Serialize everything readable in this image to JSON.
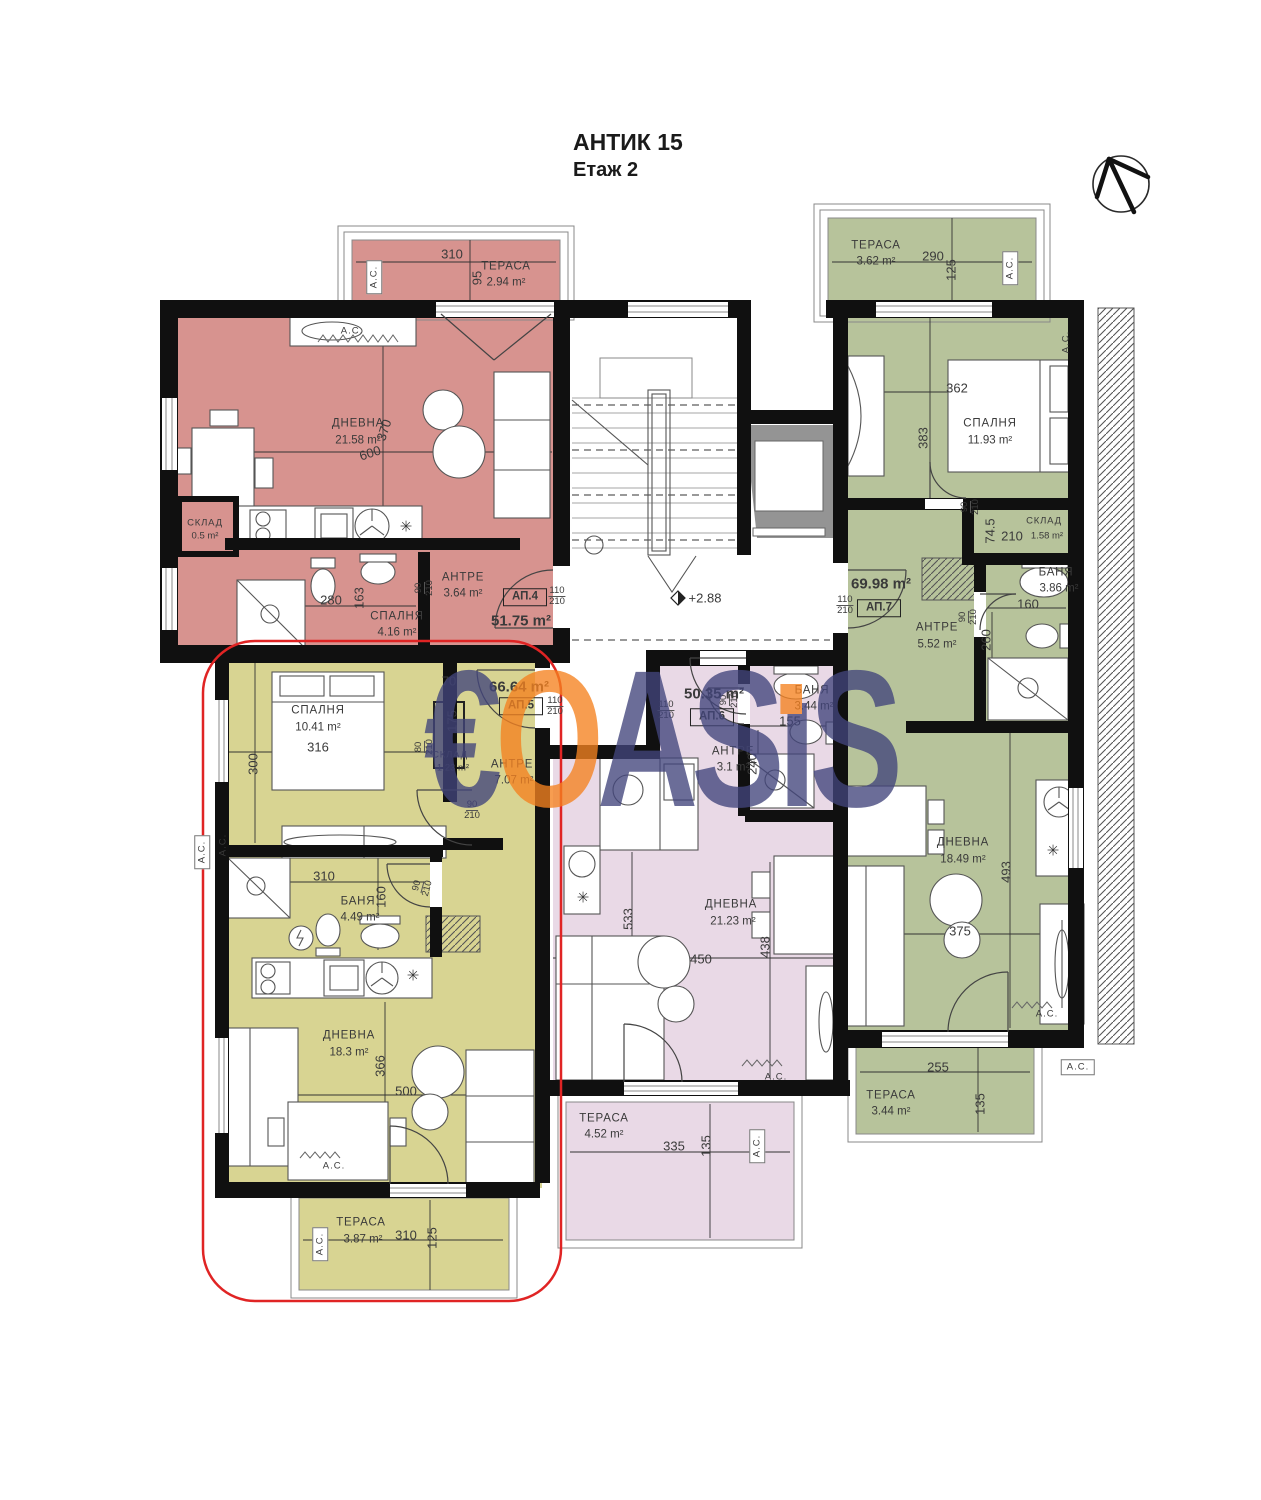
{
  "header": {
    "title": "АНТИК 15",
    "subtitle": "Етаж 2"
  },
  "level_mark": "+2.88",
  "colors": {
    "rose": "#d7938f",
    "olive": "#d8d492",
    "sage": "#b7c39b",
    "pink": "#e9d9e6",
    "outline_red": "#e02424",
    "watermark_blue": "#42457c",
    "watermark_orange": "#f58220",
    "wall_black": "#101010"
  },
  "watermark": {
    "letters": [
      {
        "ch": "€",
        "c": "#42457c"
      },
      {
        "ch": "O",
        "c": "#f58220"
      },
      {
        "ch": "A",
        "c": "#42457c"
      },
      {
        "ch": "S",
        "c": "#42457c"
      },
      {
        "ch": "ı",
        "c": "#42457c",
        "dot": "#f58220"
      },
      {
        "ch": "S",
        "c": "#42457c"
      }
    ]
  },
  "apartments": [
    {
      "id": "АП.4",
      "color_key": "rose",
      "total_area": "51.75 m²",
      "entry_door": "110/210",
      "rooms": [
        {
          "name": "ТЕРАСА",
          "area": "2.94 m²"
        },
        {
          "name": "ДНЕВНА",
          "area": "21.58 m²"
        },
        {
          "name": "СКЛАД",
          "area": "0.5 m²"
        },
        {
          "name": "СПАЛНЯ",
          "area": "4.16 m²"
        },
        {
          "name": "АНТРЕ",
          "area": "3.64 m²"
        }
      ]
    },
    {
      "id": "АП.5",
      "color_key": "olive",
      "total_area": "66.64 m²",
      "entry_door": "110/210",
      "highlighted": true,
      "rooms": [
        {
          "name": "СПАЛНЯ",
          "area": "10.41 m²"
        },
        {
          "name": "СКЛАД",
          "area": "1.23 m²"
        },
        {
          "name": "АНТРЕ",
          "area": "7.07 m²"
        },
        {
          "name": "БАНЯ",
          "area": "4.49 m²"
        },
        {
          "name": "ДНЕВНА",
          "area": "18.3 m²"
        },
        {
          "name": "ТЕРАСА",
          "area": "3.87 m²"
        }
      ]
    },
    {
      "id": "АП.6",
      "color_key": "pink",
      "total_area": "50.35 m²",
      "entry_door": "110/210",
      "rooms": [
        {
          "name": "АНТРЕ",
          "area": "3.1 m²"
        },
        {
          "name": "БАНЯ",
          "area": "3.44 m²"
        },
        {
          "name": "ДНЕВНА",
          "area": "21.23 m²"
        },
        {
          "name": "ТЕРАСА",
          "area": "4.52 m²"
        }
      ]
    },
    {
      "id": "АП.7",
      "color_key": "sage",
      "total_area": "69.98 m²",
      "entry_door": "110/210",
      "rooms": [
        {
          "name": "ТЕРАСА",
          "area": "3.62 m²"
        },
        {
          "name": "СПАЛНЯ",
          "area": "11.93 m²"
        },
        {
          "name": "СКЛАД",
          "area": "1.58 m²"
        },
        {
          "name": "БАНЯ",
          "area": "3.86 m²"
        },
        {
          "name": "АНТРЕ",
          "area": "5.52 m²"
        },
        {
          "name": "ДНЕВНА",
          "area": "18.49 m²"
        },
        {
          "name": "ТЕРАСА",
          "area": "3.44 m²"
        }
      ]
    }
  ],
  "plan": {
    "labels": [
      {
        "n": "ap4-terrace-name",
        "t": "ТЕРАСА",
        "x": 506,
        "y": 267,
        "c": "rm"
      },
      {
        "n": "ap4-terrace-area",
        "t": "2.94 m²",
        "x": 506,
        "y": 283,
        "c": "ar"
      },
      {
        "n": "ap4-terrace-ac",
        "t": "А.С.",
        "x": 374,
        "y": 277,
        "c": "acbox",
        "r": -90
      },
      {
        "n": "ap4-terrace-dim-w",
        "t": "310",
        "x": 452,
        "y": 254,
        "c": "dim"
      },
      {
        "n": "ap4-terrace-dim-h",
        "t": "95",
        "x": 477,
        "y": 278,
        "c": "dim",
        "r": -90
      },
      {
        "n": "ap4-ac",
        "t": "А.С.",
        "x": 352,
        "y": 331,
        "c": "ac"
      },
      {
        "n": "ap4-living-name",
        "t": "ДНЕВНА",
        "x": 358,
        "y": 424,
        "c": "rm"
      },
      {
        "n": "ap4-living-area",
        "t": "21.58 m²",
        "x": 358,
        "y": 441,
        "c": "ar"
      },
      {
        "n": "ap4-dim-600",
        "t": "600",
        "x": 370,
        "y": 453,
        "c": "dim",
        "r": -18
      },
      {
        "n": "ap4-dim-370",
        "t": "370",
        "x": 384,
        "y": 430,
        "c": "dim",
        "r": -72
      },
      {
        "n": "ap4-storage-name",
        "t": "СКЛАД",
        "x": 205,
        "y": 523,
        "c": "rm sm"
      },
      {
        "n": "ap4-storage-area",
        "t": "0.5 m²",
        "x": 205,
        "y": 536,
        "c": "ar sm"
      },
      {
        "n": "ap4-dim-280",
        "t": "280",
        "x": 331,
        "y": 600,
        "c": "dim"
      },
      {
        "n": "ap4-dim-163",
        "t": "163",
        "x": 359,
        "y": 598,
        "c": "dim",
        "r": -90
      },
      {
        "n": "ap4-bedroom-name",
        "t": "СПАЛНЯ",
        "x": 397,
        "y": 617,
        "c": "rm"
      },
      {
        "n": "ap4-bedroom-area",
        "t": "4.16 m²",
        "x": 397,
        "y": 633,
        "c": "ar"
      },
      {
        "n": "ap4-hall-name",
        "t": "АНТРЕ",
        "x": 463,
        "y": 578,
        "c": "rm"
      },
      {
        "n": "ap4-hall-area",
        "t": "3.64 m²",
        "x": 463,
        "y": 594,
        "c": "ar"
      },
      {
        "n": "ap4-door-90-210",
        "t": "90",
        "t2": "210",
        "x": 424,
        "y": 588,
        "c": "frac",
        "r": -90
      },
      {
        "n": "ap4-unit-label",
        "t": "АП.4",
        "x": 525,
        "y": 597,
        "c": "ap"
      },
      {
        "n": "ap4-door-110-210",
        "t": "110",
        "t2": "210",
        "x": 557,
        "y": 596,
        "c": "frac"
      },
      {
        "n": "ap4-total-area",
        "t": "51.75 m²",
        "x": 521,
        "y": 621,
        "c": "big"
      },
      {
        "n": "level-mark",
        "t": "+2.88",
        "x": 705,
        "y": 598,
        "c": "dim"
      },
      {
        "n": "ap7-terrace-top-name",
        "t": "ТЕРАСА",
        "x": 876,
        "y": 246,
        "c": "rm"
      },
      {
        "n": "ap7-terrace-top-area",
        "t": "3.62 m²",
        "x": 876,
        "y": 262,
        "c": "ar"
      },
      {
        "n": "ap7-terrace-top-dim-w",
        "t": "290",
        "x": 933,
        "y": 256,
        "c": "dim"
      },
      {
        "n": "ap7-terrace-top-dim-h",
        "t": "125",
        "x": 951,
        "y": 270,
        "c": "dim",
        "r": -90
      },
      {
        "n": "ap7-terrace-top-ac",
        "t": "А.С.",
        "x": 1010,
        "y": 268,
        "c": "acbox",
        "r": -90
      },
      {
        "n": "ap7-wardrobe-ac",
        "t": "А.С.",
        "x": 1066,
        "y": 342,
        "c": "ac sm",
        "r": -90
      },
      {
        "n": "ap7-bedroom-dim-362",
        "t": "362",
        "x": 957,
        "y": 388,
        "c": "dim"
      },
      {
        "n": "ap7-bedroom-dim-383",
        "t": "383",
        "x": 923,
        "y": 438,
        "c": "dim",
        "r": -90
      },
      {
        "n": "ap7-bedroom-name",
        "t": "СПАЛНЯ",
        "x": 990,
        "y": 424,
        "c": "rm"
      },
      {
        "n": "ap7-bedroom-area",
        "t": "11.93 m²",
        "x": 990,
        "y": 441,
        "c": "ar"
      },
      {
        "n": "ap7-storage-door",
        "t": "90",
        "t2": "210",
        "x": 970,
        "y": 507,
        "c": "frac",
        "r": -90
      },
      {
        "n": "ap7-storage-dim-745",
        "t": "74.5",
        "x": 990,
        "y": 531,
        "c": "dim",
        "r": -90
      },
      {
        "n": "ap7-storage-dim-210",
        "t": "210",
        "x": 1012,
        "y": 536,
        "c": "dim"
      },
      {
        "n": "ap7-storage-name",
        "t": "СКЛАД",
        "x": 1044,
        "y": 521,
        "c": "rm sm"
      },
      {
        "n": "ap7-storage-area",
        "t": "1.58 m²",
        "x": 1047,
        "y": 536,
        "c": "ar sm"
      },
      {
        "n": "ap7-bath-name",
        "t": "БАНЯ",
        "x": 1056,
        "y": 573,
        "c": "rm"
      },
      {
        "n": "ap7-bath-area",
        "t": "3.86 m²",
        "x": 1059,
        "y": 589,
        "c": "ar"
      },
      {
        "n": "ap7-bath-dim-160",
        "t": "160",
        "x": 1028,
        "y": 604,
        "c": "dim"
      },
      {
        "n": "ap7-bath-dim-260",
        "t": "260",
        "x": 986,
        "y": 640,
        "c": "dim",
        "r": -90
      },
      {
        "n": "ap7-bath-door",
        "t": "90",
        "t2": "210",
        "x": 968,
        "y": 617,
        "c": "frac",
        "r": -90
      },
      {
        "n": "ap7-total-area",
        "t": "69.98 m²",
        "x": 881,
        "y": 584,
        "c": "big"
      },
      {
        "n": "ap7-unit-label",
        "t": "АП.7",
        "x": 879,
        "y": 608,
        "c": "ap"
      },
      {
        "n": "ap7-door-110-210",
        "t": "110",
        "t2": "210",
        "x": 845,
        "y": 605,
        "c": "frac"
      },
      {
        "n": "ap7-hall-name",
        "t": "АНТРЕ",
        "x": 937,
        "y": 628,
        "c": "rm"
      },
      {
        "n": "ap7-hall-area",
        "t": "5.52 m²",
        "x": 937,
        "y": 645,
        "c": "ar"
      },
      {
        "n": "ap7-living-name",
        "t": "ДНЕВНА",
        "x": 963,
        "y": 843,
        "c": "rm"
      },
      {
        "n": "ap7-living-area",
        "t": "18.49 m²",
        "x": 963,
        "y": 860,
        "c": "ar"
      },
      {
        "n": "ap7-living-dim-493",
        "t": "493",
        "x": 1006,
        "y": 872,
        "c": "dim",
        "r": -90
      },
      {
        "n": "ap7-living-dim-375",
        "t": "375",
        "x": 960,
        "y": 931,
        "c": "dim"
      },
      {
        "n": "ap7-living-ac",
        "t": "А.С.",
        "x": 1047,
        "y": 1014,
        "c": "ac"
      },
      {
        "n": "ap7-terrace-bottom-dim-255",
        "t": "255",
        "x": 938,
        "y": 1067,
        "c": "dim"
      },
      {
        "n": "ap7-terrace-bottom-dim-135",
        "t": "135",
        "x": 980,
        "y": 1104,
        "c": "dim",
        "r": -90
      },
      {
        "n": "ap7-terrace-bottom-name",
        "t": "ТЕРАСА",
        "x": 891,
        "y": 1096,
        "c": "rm"
      },
      {
        "n": "ap7-terrace-bottom-area",
        "t": "3.44 m²",
        "x": 891,
        "y": 1112,
        "c": "ar"
      },
      {
        "n": "ap7-terrace-bottom-ac",
        "t": "А.С.",
        "x": 1078,
        "y": 1067,
        "c": "acbox"
      },
      {
        "n": "ap6-total-area",
        "t": "50.35 m²",
        "x": 714,
        "y": 694,
        "c": "big"
      },
      {
        "n": "ap6-unit-label",
        "t": "АП.6",
        "x": 712,
        "y": 717,
        "c": "ap"
      },
      {
        "n": "ap6-door-110-210",
        "t": "110",
        "t2": "210",
        "x": 666,
        "y": 710,
        "c": "frac"
      },
      {
        "n": "ap6-bath-door",
        "t": "90",
        "t2": "210",
        "x": 729,
        "y": 700,
        "c": "frac",
        "r": -90
      },
      {
        "n": "ap6-bath-name",
        "t": "БАНЯ",
        "x": 812,
        "y": 691,
        "c": "rm"
      },
      {
        "n": "ap6-bath-area",
        "t": "3.44 m²",
        "x": 814,
        "y": 707,
        "c": "ar"
      },
      {
        "n": "ap6-bath-dim-155",
        "t": "155",
        "x": 790,
        "y": 721,
        "c": "dim"
      },
      {
        "n": "ap6-bath-dim-240",
        "t": "240",
        "x": 752,
        "y": 764,
        "c": "dim",
        "r": -90
      },
      {
        "n": "ap6-hall-name",
        "t": "АНТРЕ",
        "x": 733,
        "y": 752,
        "c": "rm"
      },
      {
        "n": "ap6-hall-area",
        "t": "3.1 m²",
        "x": 733,
        "y": 768,
        "c": "ar"
      },
      {
        "n": "ap6-living-name",
        "t": "ДНЕВНА",
        "x": 731,
        "y": 905,
        "c": "rm"
      },
      {
        "n": "ap6-living-area",
        "t": "21.23 m²",
        "x": 733,
        "y": 922,
        "c": "ar"
      },
      {
        "n": "ap6-living-dim-533",
        "t": "533",
        "x": 628,
        "y": 919,
        "c": "dim",
        "r": -90
      },
      {
        "n": "ap6-living-dim-450",
        "t": "450",
        "x": 701,
        "y": 959,
        "c": "dim"
      },
      {
        "n": "ap6-living-dim-438",
        "t": "438",
        "x": 765,
        "y": 947,
        "c": "dim",
        "r": -90
      },
      {
        "n": "ap6-living-ac",
        "t": "А.С.",
        "x": 776,
        "y": 1077,
        "c": "ac"
      },
      {
        "n": "ap6-terrace-name",
        "t": "ТЕРАСА",
        "x": 604,
        "y": 1119,
        "c": "rm"
      },
      {
        "n": "ap6-terrace-area",
        "t": "4.52 m²",
        "x": 604,
        "y": 1135,
        "c": "ar"
      },
      {
        "n": "ap6-terrace-dim-335",
        "t": "335",
        "x": 674,
        "y": 1146,
        "c": "dim"
      },
      {
        "n": "ap6-terrace-dim-135",
        "t": "135",
        "x": 706,
        "y": 1146,
        "c": "dim",
        "r": -90
      },
      {
        "n": "ap6-terrace-ac",
        "t": "А.С.",
        "x": 757,
        "y": 1146,
        "c": "acbox",
        "r": -90
      },
      {
        "n": "ap5-bedroom-name",
        "t": "СПАЛНЯ",
        "x": 318,
        "y": 711,
        "c": "rm"
      },
      {
        "n": "ap5-bedroom-area",
        "t": "10.41 m²",
        "x": 318,
        "y": 728,
        "c": "ar"
      },
      {
        "n": "ap5-bedroom-dim-316",
        "t": "316",
        "x": 318,
        "y": 747,
        "c": "dim"
      },
      {
        "n": "ap5-bedroom-dim-300",
        "t": "300",
        "x": 253,
        "y": 764,
        "c": "dim",
        "r": -90
      },
      {
        "n": "ap5-storage-dim-70",
        "t": "70",
        "x": 449,
        "y": 681,
        "c": "dim"
      },
      {
        "n": "ap5-storage-dim-175",
        "t": "175",
        "x": 452,
        "y": 721,
        "c": "dim",
        "r": -90
      },
      {
        "n": "ap5-storage-door",
        "t": "80",
        "t2": "210",
        "x": 424,
        "y": 747,
        "c": "frac",
        "r": -90
      },
      {
        "n": "ap5-storage-name",
        "t": "СКЛАД",
        "x": 450,
        "y": 755,
        "c": "rm sm"
      },
      {
        "n": "ap5-storage-area",
        "t": "1.23 m²",
        "x": 453,
        "y": 768,
        "c": "ar sm"
      },
      {
        "n": "ap5-total-area",
        "t": "66.64 m²",
        "x": 519,
        "y": 687,
        "c": "big"
      },
      {
        "n": "ap5-unit-label",
        "t": "АП.5",
        "x": 521,
        "y": 706,
        "c": "ap"
      },
      {
        "n": "ap5-door-110-210",
        "t": "110",
        "t2": "210",
        "x": 555,
        "y": 706,
        "c": "frac"
      },
      {
        "n": "ap5-hall-name",
        "t": "АНТРЕ",
        "x": 512,
        "y": 765,
        "c": "rm"
      },
      {
        "n": "ap5-hall-area",
        "t": "7.07 m²",
        "x": 514,
        "y": 781,
        "c": "ar"
      },
      {
        "n": "ap5-bedroom-door",
        "t": "90",
        "t2": "210",
        "x": 472,
        "y": 810,
        "c": "frac"
      },
      {
        "n": "ap5-ac-outer",
        "t": "А.С.",
        "x": 202,
        "y": 852,
        "c": "acbox",
        "r": -90
      },
      {
        "n": "ap5-ac-inner",
        "t": "А.С.",
        "x": 223,
        "y": 845,
        "c": "ac sm",
        "r": -90
      },
      {
        "n": "ap5-bath-dim-310",
        "t": "310",
        "x": 324,
        "y": 876,
        "c": "dim"
      },
      {
        "n": "ap5-bath-name",
        "t": "БАНЯ",
        "x": 358,
        "y": 902,
        "c": "rm"
      },
      {
        "n": "ap5-bath-area",
        "t": "4.49 m²",
        "x": 360,
        "y": 918,
        "c": "ar"
      },
      {
        "n": "ap5-bath-dim-160",
        "t": "160",
        "x": 381,
        "y": 897,
        "c": "dim",
        "r": -90
      },
      {
        "n": "ap5-bath-door",
        "t": "90",
        "t2": "210",
        "x": 422,
        "y": 887,
        "c": "frac",
        "r": -75
      },
      {
        "n": "ap5-living-name",
        "t": "ДНЕВНА",
        "x": 349,
        "y": 1036,
        "c": "rm"
      },
      {
        "n": "ap5-living-area",
        "t": "18.3 m²",
        "x": 349,
        "y": 1053,
        "c": "ar"
      },
      {
        "n": "ap5-living-dim-366",
        "t": "366",
        "x": 380,
        "y": 1066,
        "c": "dim",
        "r": -90
      },
      {
        "n": "ap5-living-dim-500",
        "t": "500",
        "x": 406,
        "y": 1091,
        "c": "dim"
      },
      {
        "n": "ap5-living-ac",
        "t": "А.С.",
        "x": 334,
        "y": 1166,
        "c": "ac"
      },
      {
        "n": "ap5-terrace-name",
        "t": "ТЕРАСА",
        "x": 361,
        "y": 1223,
        "c": "rm"
      },
      {
        "n": "ap5-terrace-area",
        "t": "3.87 m²",
        "x": 363,
        "y": 1240,
        "c": "ar"
      },
      {
        "n": "ap5-terrace-dim-310",
        "t": "310",
        "x": 406,
        "y": 1235,
        "c": "dim"
      },
      {
        "n": "ap5-terrace-dim-125",
        "t": "125",
        "x": 432,
        "y": 1238,
        "c": "dim",
        "r": -90
      },
      {
        "n": "ap5-terrace-ac",
        "t": "А.С.",
        "x": 320,
        "y": 1244,
        "c": "acbox",
        "r": -90
      },
      {
        "n": "ap4-ceiling-light-symbol",
        "t": "✳",
        "x": 406,
        "y": 527,
        "c": "sym"
      },
      {
        "n": "ap5-ceiling-light-symbol",
        "t": "✳",
        "x": 413,
        "y": 976,
        "c": "sym"
      },
      {
        "n": "ap6-ceiling-light-symbol",
        "t": "✳",
        "x": 583,
        "y": 898,
        "c": "sym"
      },
      {
        "n": "ap7-ceiling-light-symbol",
        "t": "✳",
        "x": 1053,
        "y": 851,
        "c": "sym"
      }
    ]
  }
}
